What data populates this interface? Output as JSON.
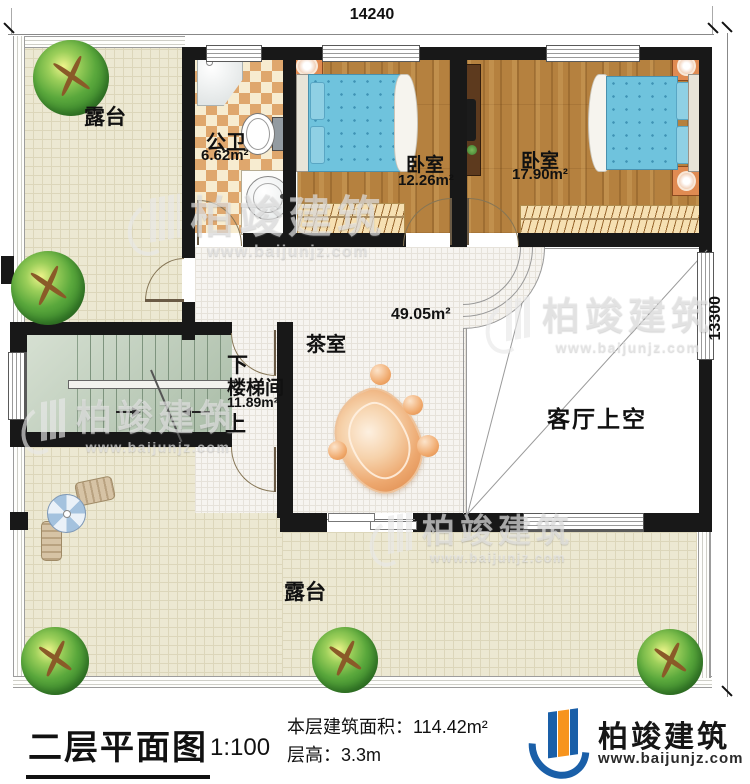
{
  "dimensions": {
    "top": "14240",
    "right": "13300"
  },
  "rooms": {
    "terrace_top": {
      "label": "露台"
    },
    "bathroom": {
      "label": "公卫",
      "area": "6.62m²"
    },
    "bedroom_left": {
      "label": "卧室",
      "area": "12.26m²"
    },
    "bedroom_right": {
      "label": "卧室",
      "area": "17.90m²"
    },
    "stairwell": {
      "label": "楼梯间",
      "area": "11.89m²",
      "down": "下",
      "up": "上"
    },
    "tea_room": {
      "label": "茶室",
      "area": "49.05m²"
    },
    "living_void": {
      "label": "客厅上空"
    },
    "terrace_bottom": {
      "label": "露台"
    }
  },
  "watermark": {
    "brand": "柏竣建筑",
    "site": "www.baijunjz.com"
  },
  "footer": {
    "title": "二层平面图",
    "scale": "1:100",
    "area_line": "本层建筑面积：114.42m²",
    "height_line": "层高：3.3m",
    "brand": "柏竣建筑",
    "site": "www.baijunjz.com"
  },
  "colors": {
    "wall": "#181818",
    "wood_floor": "#b5813f",
    "bed_blue": "#6fc3dd",
    "terrace_beige": "#ece8d2",
    "checker_tan": "#dfa76d",
    "stair_sage": "#b9c9b6",
    "stone_orange": "#eda86f",
    "brand_blue": "#1a5fa8",
    "brand_orange": "#f7941d"
  }
}
